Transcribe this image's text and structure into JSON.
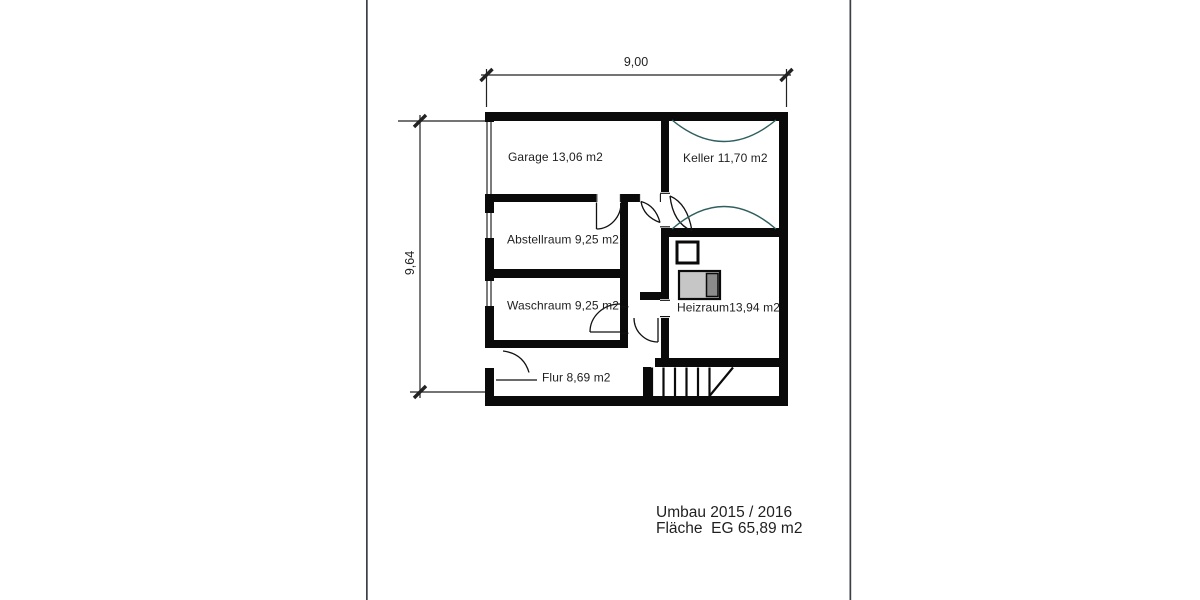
{
  "floorplan": {
    "dimensions": {
      "top": "9,00",
      "left": "9,64"
    },
    "rooms": {
      "garage": {
        "label": "Garage 13,06 m2"
      },
      "keller": {
        "label": "Keller 11,70 m2"
      },
      "abstellraum": {
        "label": "Abstellraum 9,25 m2"
      },
      "waschraum": {
        "label": "Waschraum 9,25 m2"
      },
      "heizraum": {
        "label": "Heizraum13,94 m2"
      },
      "flur": {
        "label": "Flur 8,69 m2"
      }
    },
    "footer": {
      "line1": "Umbau 2015 / 2016",
      "line2": "Fläche  EG 65,89 m2"
    },
    "colors": {
      "wall": "#0a0a0a",
      "vault_arc": "#2e5e5e",
      "boiler_body": "#c6c6c6",
      "boiler_end": "#8b8b8b",
      "text": "#1f1f1f",
      "page_border": "#3b4045"
    }
  }
}
